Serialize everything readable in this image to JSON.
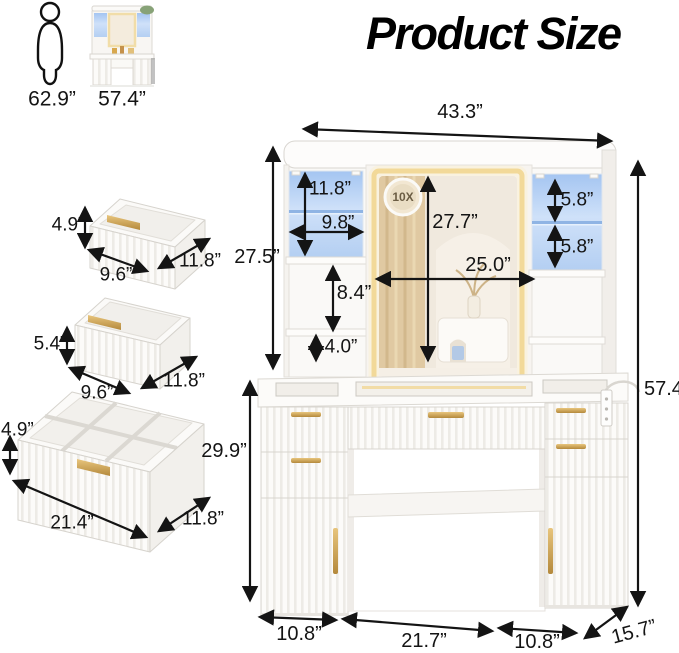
{
  "title": "Product Size",
  "reference": {
    "person_height": "62.9”",
    "product_height": "57.4”"
  },
  "drawers": {
    "top": {
      "height": "4.9”",
      "width": "9.6”",
      "depth": "11.8”"
    },
    "middle": {
      "height": "5.4”",
      "width": "9.6”",
      "depth": "11.8”"
    },
    "bottom": {
      "height": "4.9”",
      "width": "21.4”",
      "depth": "11.8”"
    }
  },
  "vanity": {
    "overall_width": "43.3”",
    "hutch_height": "27.5”",
    "left_cabinet_height": "11.8”",
    "left_cabinet_width": "9.8”",
    "magnifier_label": "10X",
    "mirror_height": "27.7”",
    "mirror_width": "25.0”",
    "left_shelf_gap": "8.4”",
    "left_shelf_gap_small": "4.0”",
    "right_shelf_upper": "5.8”",
    "right_shelf_lower": "5.8”",
    "total_height": "57.4”",
    "desk_height": "29.9”",
    "left_pedestal_width": "10.8”",
    "knee_space_width": "21.7”",
    "right_pedestal_width": "10.8”",
    "depth": "15.7”"
  },
  "colors": {
    "accent_gold": "#c09a4e",
    "led_blue": "#b7d0f2",
    "led_warm": "#f2d999",
    "arrow": "#141414"
  }
}
